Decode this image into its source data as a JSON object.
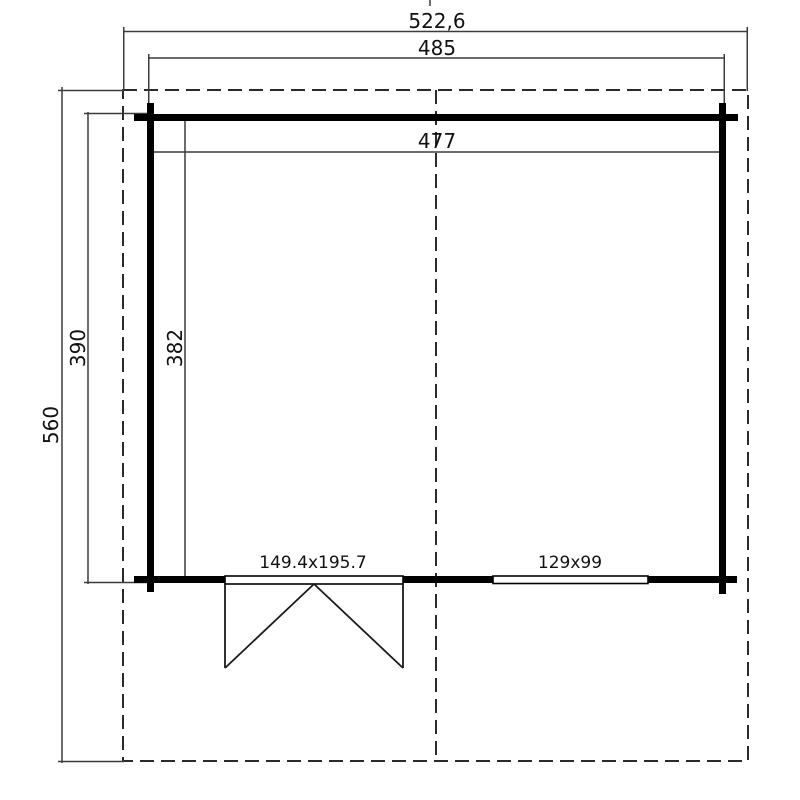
{
  "drawing": {
    "kind": "floor-plan",
    "labels": {
      "total_width": "522,6",
      "outer_width": "485",
      "inner_width": "477",
      "total_depth": "560",
      "outer_depth": "390",
      "inner_depth": "382",
      "door": "149.4x195.7",
      "window": "129x99"
    },
    "colors": {
      "background": "#ffffff",
      "wall_line": "#000000",
      "thin_line": "#3c3c3c",
      "dashed_line": "#2a2a2a",
      "text": "#111111"
    },
    "line_styles": {
      "roof_outline": "dashed",
      "ridge_centerline": "dashed",
      "walls": "solid-thick",
      "dimensions": "solid-thin"
    }
  }
}
